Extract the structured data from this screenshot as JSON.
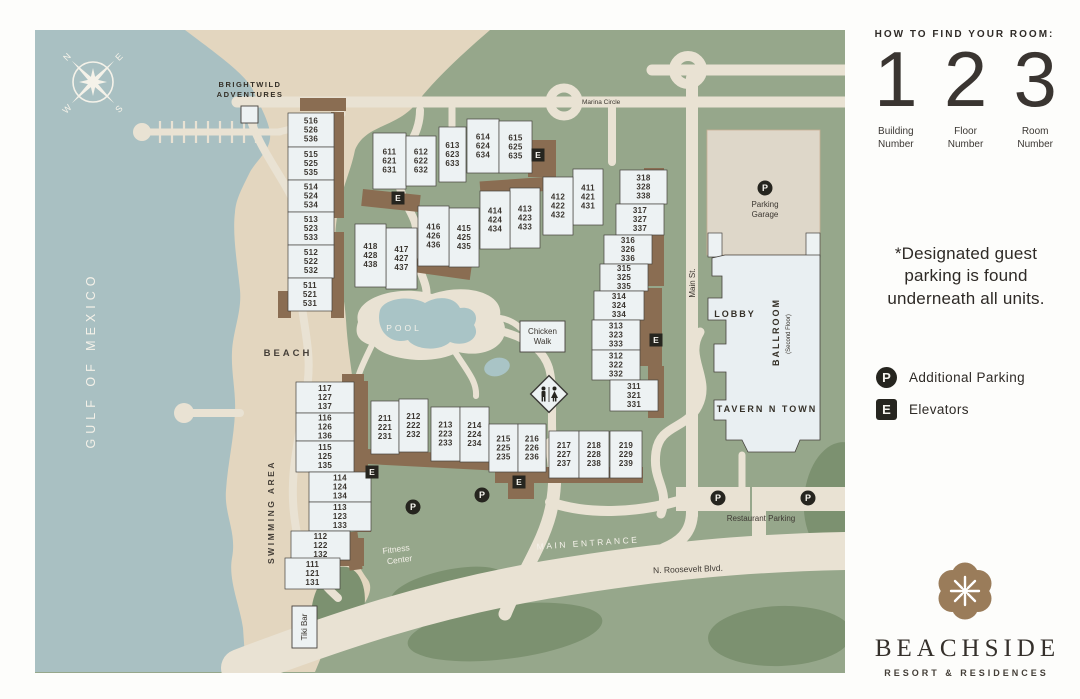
{
  "panel": {
    "how_to_title": "HOW TO FIND YOUR ROOM:",
    "steps": [
      {
        "digit": "1",
        "label_line1": "Building",
        "label_line2": "Number"
      },
      {
        "digit": "2",
        "label_line1": "Floor",
        "label_line2": "Number"
      },
      {
        "digit": "3",
        "label_line1": "Room",
        "label_line2": "Number"
      }
    ],
    "note": "*Designated guest parking is found underneath all units.",
    "legend": [
      {
        "symbol": "P",
        "label": "Additional Parking",
        "shape": "circle"
      },
      {
        "symbol": "E",
        "label": "Elevators",
        "shape": "square"
      }
    ],
    "logo_name": "BEACHSIDE",
    "logo_tagline": "RESORT & RESIDENCES"
  },
  "map": {
    "compass": {
      "n": "N",
      "e": "E",
      "s": "S",
      "w": "W"
    },
    "gulf_label": "GULF OF MEXICO",
    "beach_label": "BEACH",
    "swimming_area_label": "SWIMMING AREA",
    "pool_label": "POOL",
    "brightwild_line1": "BRIGHTWILD",
    "brightwild_line2": "ADVENTURES",
    "marina_circle_label": "Marina Circle",
    "main_st_label": "Main St.",
    "main_entrance_label": "MAIN ENTRANCE",
    "roosevelt_label": "N. Roosevelt Blvd.",
    "restaurant_parking_label": "Restaurant Parking",
    "fitness_line1": "Fitness",
    "fitness_line2": "Center",
    "tiki_bar_label": "Tiki Bar",
    "chicken_walk_line1": "Chicken",
    "chicken_walk_line2": "Walk",
    "parking_garage_line1": "Parking",
    "parking_garage_line2": "Garage",
    "lobby_label": "LOBBY",
    "ballroom_label": "BALLROOM",
    "ballroom_sub_label": "(Second Floor)",
    "tavern_label": "TAVERN N TOWN",
    "elevator_letter": "E",
    "parking_letter": "P",
    "buildings": [
      {
        "lines": [
          "516",
          "526",
          "536"
        ],
        "x": 288,
        "y": 113,
        "w": 46,
        "h": 34
      },
      {
        "lines": [
          "515",
          "525",
          "535"
        ],
        "x": 288,
        "y": 147,
        "w": 46,
        "h": 33
      },
      {
        "lines": [
          "514",
          "524",
          "534"
        ],
        "x": 288,
        "y": 180,
        "w": 46,
        "h": 32
      },
      {
        "lines": [
          "513",
          "523",
          "533"
        ],
        "x": 288,
        "y": 212,
        "w": 46,
        "h": 33
      },
      {
        "lines": [
          "512",
          "522",
          "532"
        ],
        "x": 288,
        "y": 245,
        "w": 46,
        "h": 33
      },
      {
        "lines": [
          "511",
          "521",
          "531"
        ],
        "x": 288,
        "y": 278,
        "w": 44,
        "h": 33
      },
      {
        "lines": [
          "611",
          "621",
          "631"
        ],
        "x": 373,
        "y": 133,
        "w": 33,
        "h": 56
      },
      {
        "lines": [
          "612",
          "622",
          "632"
        ],
        "x": 406,
        "y": 136,
        "w": 30,
        "h": 50
      },
      {
        "lines": [
          "613",
          "623",
          "633"
        ],
        "x": 439,
        "y": 127,
        "w": 27,
        "h": 55
      },
      {
        "lines": [
          "614",
          "624",
          "634"
        ],
        "x": 467,
        "y": 119,
        "w": 32,
        "h": 54
      },
      {
        "lines": [
          "615",
          "625",
          "635"
        ],
        "x": 499,
        "y": 121,
        "w": 33,
        "h": 52
      },
      {
        "lines": [
          "411",
          "421",
          "431"
        ],
        "x": 573,
        "y": 169,
        "w": 30,
        "h": 56
      },
      {
        "lines": [
          "412",
          "422",
          "432"
        ],
        "x": 543,
        "y": 177,
        "w": 30,
        "h": 58
      },
      {
        "lines": [
          "413",
          "423",
          "433"
        ],
        "x": 510,
        "y": 188,
        "w": 30,
        "h": 60
      },
      {
        "lines": [
          "414",
          "424",
          "434"
        ],
        "x": 480,
        "y": 191,
        "w": 30,
        "h": 58
      },
      {
        "lines": [
          "415",
          "425",
          "435"
        ],
        "x": 449,
        "y": 208,
        "w": 30,
        "h": 59
      },
      {
        "lines": [
          "416",
          "426",
          "436"
        ],
        "x": 418,
        "y": 206,
        "w": 31,
        "h": 60
      },
      {
        "lines": [
          "417",
          "427",
          "437"
        ],
        "x": 386,
        "y": 228,
        "w": 31,
        "h": 61
      },
      {
        "lines": [
          "418",
          "428",
          "438"
        ],
        "x": 355,
        "y": 224,
        "w": 31,
        "h": 63
      },
      {
        "lines": [
          "318",
          "328",
          "338"
        ],
        "x": 620,
        "y": 170,
        "w": 47,
        "h": 34
      },
      {
        "lines": [
          "317",
          "327",
          "337"
        ],
        "x": 616,
        "y": 204,
        "w": 48,
        "h": 31
      },
      {
        "lines": [
          "316",
          "326",
          "336"
        ],
        "x": 604,
        "y": 235,
        "w": 48,
        "h": 29
      },
      {
        "lines": [
          "315",
          "325",
          "335"
        ],
        "x": 600,
        "y": 264,
        "w": 48,
        "h": 27
      },
      {
        "lines": [
          "314",
          "324",
          "334"
        ],
        "x": 594,
        "y": 291,
        "w": 50,
        "h": 29
      },
      {
        "lines": [
          "313",
          "323",
          "333"
        ],
        "x": 592,
        "y": 320,
        "w": 48,
        "h": 30
      },
      {
        "lines": [
          "312",
          "322",
          "332"
        ],
        "x": 592,
        "y": 350,
        "w": 48,
        "h": 30
      },
      {
        "lines": [
          "311",
          "321",
          "331"
        ],
        "x": 610,
        "y": 380,
        "w": 48,
        "h": 31
      },
      {
        "lines": [
          "211",
          "221",
          "231"
        ],
        "x": 371,
        "y": 401,
        "w": 28,
        "h": 53
      },
      {
        "lines": [
          "212",
          "222",
          "232"
        ],
        "x": 399,
        "y": 399,
        "w": 29,
        "h": 53
      },
      {
        "lines": [
          "213",
          "223",
          "233"
        ],
        "x": 431,
        "y": 407,
        "w": 29,
        "h": 54
      },
      {
        "lines": [
          "214",
          "224",
          "234"
        ],
        "x": 460,
        "y": 407,
        "w": 29,
        "h": 55
      },
      {
        "lines": [
          "215",
          "225",
          "235"
        ],
        "x": 489,
        "y": 424,
        "w": 29,
        "h": 48
      },
      {
        "lines": [
          "216",
          "226",
          "236"
        ],
        "x": 518,
        "y": 424,
        "w": 28,
        "h": 48
      },
      {
        "lines": [
          "217",
          "227",
          "237"
        ],
        "x": 549,
        "y": 431,
        "w": 30,
        "h": 47
      },
      {
        "lines": [
          "218",
          "228",
          "238"
        ],
        "x": 579,
        "y": 431,
        "w": 30,
        "h": 47
      },
      {
        "lines": [
          "219",
          "229",
          "239"
        ],
        "x": 610,
        "y": 431,
        "w": 32,
        "h": 47
      },
      {
        "lines": [
          "117",
          "127",
          "137"
        ],
        "x": 296,
        "y": 382,
        "w": 58,
        "h": 31
      },
      {
        "lines": [
          "116",
          "126",
          "136"
        ],
        "x": 296,
        "y": 413,
        "w": 58,
        "h": 28
      },
      {
        "lines": [
          "115",
          "125",
          "135"
        ],
        "x": 296,
        "y": 441,
        "w": 58,
        "h": 31
      },
      {
        "lines": [
          "114",
          "124",
          "134"
        ],
        "x": 309,
        "y": 472,
        "w": 62,
        "h": 30
      },
      {
        "lines": [
          "113",
          "123",
          "133"
        ],
        "x": 309,
        "y": 502,
        "w": 62,
        "h": 29
      },
      {
        "lines": [
          "112",
          "122",
          "132"
        ],
        "x": 291,
        "y": 531,
        "w": 59,
        "h": 29
      },
      {
        "lines": [
          "111",
          "121",
          "131"
        ],
        "x": 285,
        "y": 558,
        "w": 55,
        "h": 31
      }
    ],
    "elevators": [
      {
        "x": 538,
        "y": 155
      },
      {
        "x": 398,
        "y": 198
      },
      {
        "x": 656,
        "y": 340
      },
      {
        "x": 372,
        "y": 472
      },
      {
        "x": 519,
        "y": 482
      }
    ],
    "parking_spots": [
      {
        "x": 765,
        "y": 188
      },
      {
        "x": 718,
        "y": 498
      },
      {
        "x": 808,
        "y": 498
      },
      {
        "x": 413,
        "y": 507
      },
      {
        "x": 482,
        "y": 495
      }
    ]
  },
  "colors": {
    "green": "#96a78b",
    "dark_green": "#7c9170",
    "water": "#a9c0c2",
    "sand": "#e3d6bf",
    "road": "#e9e2d3",
    "brown": "#8a6d52",
    "building_fill": "#edf2f3",
    "building_stroke": "#45423d",
    "badge": "#26251f",
    "garage_fill": "#ded7c9",
    "brand_brown": "#9a7c5a",
    "map_text_dark": "#3a352f",
    "map_text_light": "#f5f2e9"
  }
}
